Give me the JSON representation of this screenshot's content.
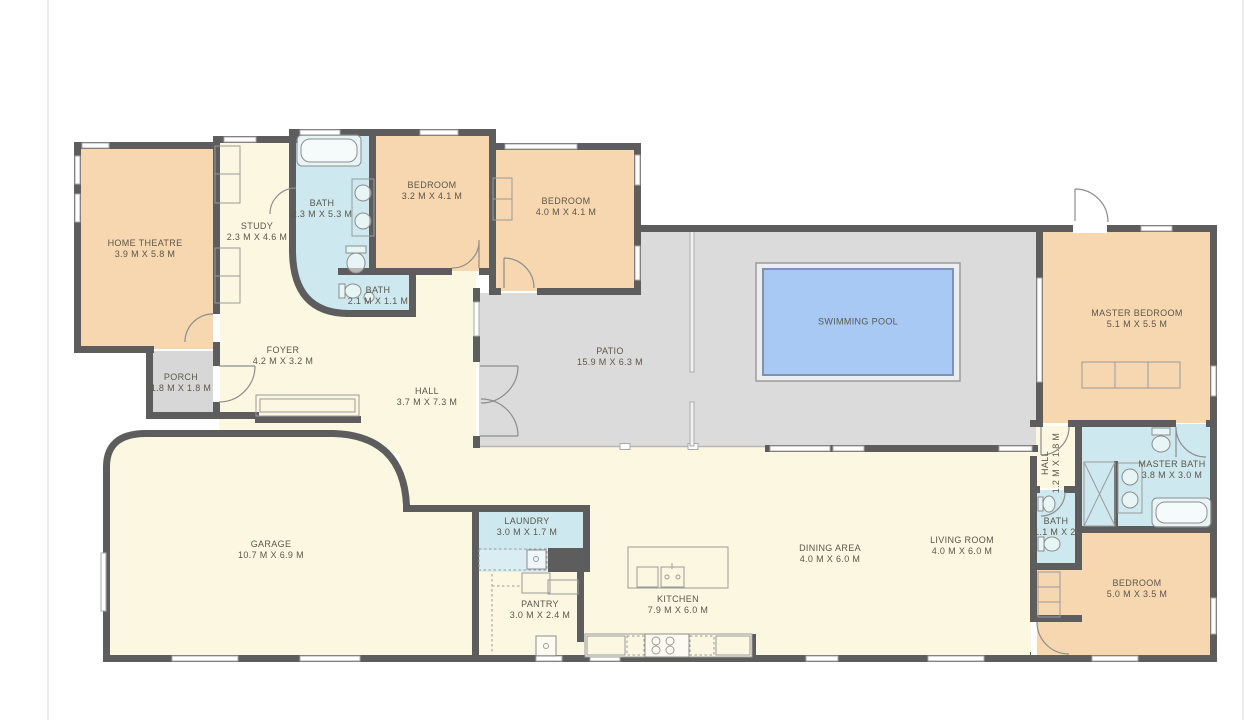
{
  "plan": {
    "colors": {
      "wall": "#5d5d5d",
      "room_cream": "#fbf7e1",
      "room_orange": "#f6d7b0",
      "room_wet_blue": "#cde8ee",
      "patio_gray": "#dbdbdb",
      "porch_gray": "#d7d7d7",
      "pool_water": "#a7c9f4",
      "label_text": "#5c5749"
    },
    "rooms": {
      "home_theatre": {
        "name": "HOME THEATRE",
        "dims": "3.9 M X 5.8 M"
      },
      "study": {
        "name": "STUDY",
        "dims": "2.3 M X 4.6 M"
      },
      "bath_top": {
        "name": "BATH",
        "dims": "2.3 M X 5.3 M"
      },
      "bedroom_1": {
        "name": "BEDROOM",
        "dims": "3.2 M X 4.1 M"
      },
      "bedroom_2": {
        "name": "BEDROOM",
        "dims": "4.0 M X 4.1 M"
      },
      "bath_small": {
        "name": "BATH",
        "dims": "2.1 M X 1.1 M"
      },
      "porch": {
        "name": "PORCH",
        "dims": "1.8 M X 1.8 M"
      },
      "foyer": {
        "name": "FOYER",
        "dims": "4.2 M X 3.2 M"
      },
      "hall": {
        "name": "HALL",
        "dims": "3.7 M X 7.3 M"
      },
      "patio": {
        "name": "PATIO",
        "dims": "15.9 M X 6.3 M"
      },
      "swimming_pool": {
        "name": "SWIMMING POOL"
      },
      "master_bedroom": {
        "name": "MASTER BEDROOM",
        "dims": "5.1 M X 5.5 M"
      },
      "hall_small": {
        "name": "HALL",
        "dims": "1.2 M X 1.8 M"
      },
      "master_bath": {
        "name": "MASTER BATH",
        "dims": "3.8 M X 3.0 M"
      },
      "bath_ensuite": {
        "name": "BATH",
        "dims": "1.1 M X 2.1 M"
      },
      "bedroom_3": {
        "name": "BEDROOM",
        "dims": "5.0 M X 3.5 M"
      },
      "living_room": {
        "name": "LIVING ROOM",
        "dims": "4.0 M X 6.0 M"
      },
      "dining_area": {
        "name": "DINING AREA",
        "dims": "4.0 M X 6.0 M"
      },
      "kitchen": {
        "name": "KITCHEN",
        "dims": "7.9 M X 6.0 M"
      },
      "laundry": {
        "name": "LAUNDRY",
        "dims": "3.0 M X 1.7 M"
      },
      "pantry": {
        "name": "PANTRY",
        "dims": "3.0 M X 2.4 M"
      },
      "garage": {
        "name": "GARAGE",
        "dims": "10.7 M X 6.9 M"
      }
    }
  }
}
